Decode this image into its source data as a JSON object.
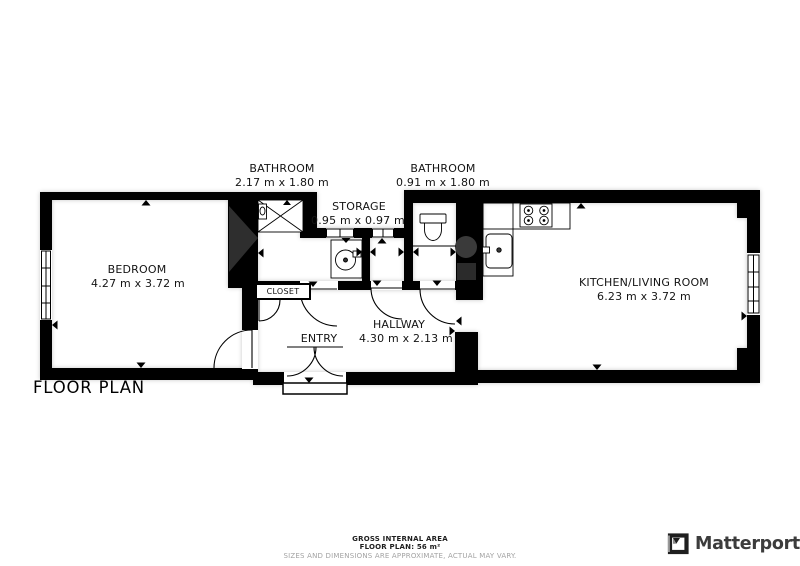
{
  "title": {
    "text": "FLOOR PLAN"
  },
  "rooms": {
    "bedroom": {
      "name": "BEDROOM",
      "dims": "4.27 m x 3.72 m"
    },
    "bathroom1": {
      "name": "BATHROOM",
      "dims": "2.17 m x 1.80 m"
    },
    "bathroom2": {
      "name": "BATHROOM",
      "dims": "0.91 m x 1.80 m"
    },
    "storage": {
      "name": "STORAGE",
      "dims": "0.95 m x 0.97 m"
    },
    "hallway": {
      "name": "HALLWAY",
      "dims": "4.30 m x 2.13 m"
    },
    "kitchen_living": {
      "name": "KITCHEN/LIVING ROOM",
      "dims": "6.23 m x 3.72 m"
    },
    "entry": {
      "name": "ENTRY"
    },
    "closet": {
      "name": "CLOSET"
    }
  },
  "footer": {
    "line1": "GROSS INTERNAL AREA",
    "line2": "FLOOR PLAN: 56 m²",
    "line3": "SIZES AND DIMENSIONS ARE APPROXIMATE, ACTUAL MAY VARY."
  },
  "brand": {
    "name": "Matterport",
    "icon": "matterport-logo-icon"
  },
  "colors": {
    "wall": "#000000",
    "scan_shadow": "#2e2e2e",
    "boiler": "#3a3a3a",
    "disclaimer_text": "#a3a3a3",
    "brand_text": "#3c3c3c"
  }
}
